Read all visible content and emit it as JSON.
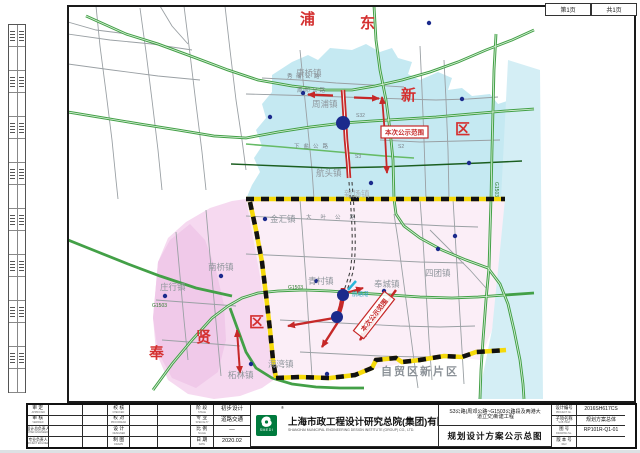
{
  "sheet": {
    "page_label": "第1页",
    "total_label": "共1页"
  },
  "map": {
    "districts": {
      "pu": "浦",
      "dong": "东",
      "xin": "新",
      "qu1": "区",
      "feng": "奉",
      "xian": "贤",
      "qu2": "区"
    },
    "towns": {
      "kangqiao": "康桥镇",
      "zhoupu": "周浦镇",
      "hangtou": "航头镇",
      "xinchang": "新场镇",
      "jinhui": "金汇镇",
      "nanqiao": "南桥镇",
      "zhuangxing": "庄行镇",
      "tuolin": "柘林镇",
      "haiwan": "海湾镇",
      "qingcun": "青村镇",
      "fengcheng": "奉城镇",
      "situan": "四团镇"
    },
    "zone_label": "自贸区新片区",
    "notice_box1": "本次公示范围",
    "notice_box2": "本次公示范围",
    "roads": {
      "xiupu": "秀浦公路",
      "zhoudeng": "周邓公路",
      "xiayan": "下盐公路",
      "daye": "大叶公路",
      "hangtanggang": "航塘港",
      "g1503a": "G1503",
      "g1503b": "G1503",
      "g1503c": "G1503",
      "s32": "S32",
      "s2": "S2",
      "s3": "S3"
    },
    "colors": {
      "pudong_fill": "#c5e9f2",
      "fengxian_fill": "#f6d9f0",
      "boundary_yellow": "#f5d90a",
      "highway_green": "#43a047",
      "plan_red": "#c62828",
      "node_blue": "#1b2a8c"
    }
  },
  "titleblock": {
    "col_a": [
      {
        "cn": "审 定",
        "en": "APPROVED"
      },
      {
        "cn": "审 核",
        "en": "VERIFIED"
      },
      {
        "cn": "设计总负责人",
        "en": "CHIEF ENGINEER"
      },
      {
        "cn": "专业负责人",
        "en": "PROJECT ENGINEER"
      }
    ],
    "col_b": [
      {
        "cn": "校 核",
        "en": "CHECKED"
      },
      {
        "cn": "校 对",
        "en": "PROOFREAD"
      },
      {
        "cn": "设 计",
        "en": "DESIGNED"
      },
      {
        "cn": "制 图",
        "en": "DRAWN"
      }
    ],
    "col_c": [
      {
        "cn": "阶 段",
        "en": "STAGE",
        "value": "初步设计"
      },
      {
        "cn": "专 业",
        "en": "SPECIALTY",
        "value": "道路交通"
      },
      {
        "cn": "比 例",
        "en": "SCALE",
        "value": "—"
      },
      {
        "cn": "日 期",
        "en": "DATE",
        "value": "2020.02"
      }
    ],
    "company": {
      "logo": "SMEDI",
      "reg": "®",
      "cn": "上海市政工程设计研究总院(集团)有限公司",
      "en": "SHANGHAI MUNICIPAL ENGINEERING DESIGN INSTITUTE (GROUP) CO., LTD."
    },
    "project": {
      "line1": "S3公路(周邓公路~G1503公路段及两港大",
      "line2": "道立交)新建工程"
    },
    "drawing_title": "规划设计方案公示总图",
    "info": [
      {
        "cn": "设计编号",
        "en": "PROJECT No.",
        "value": "2016SH617CS"
      },
      {
        "cn": "子项名称",
        "en": "SUB ITEM",
        "value": "规划方案总体"
      },
      {
        "cn": "图 号",
        "en": "DRAWING No.",
        "value": "RP101R-Q1-01"
      },
      {
        "cn": "版 本 号",
        "en": "REV.",
        "value": ""
      }
    ]
  }
}
